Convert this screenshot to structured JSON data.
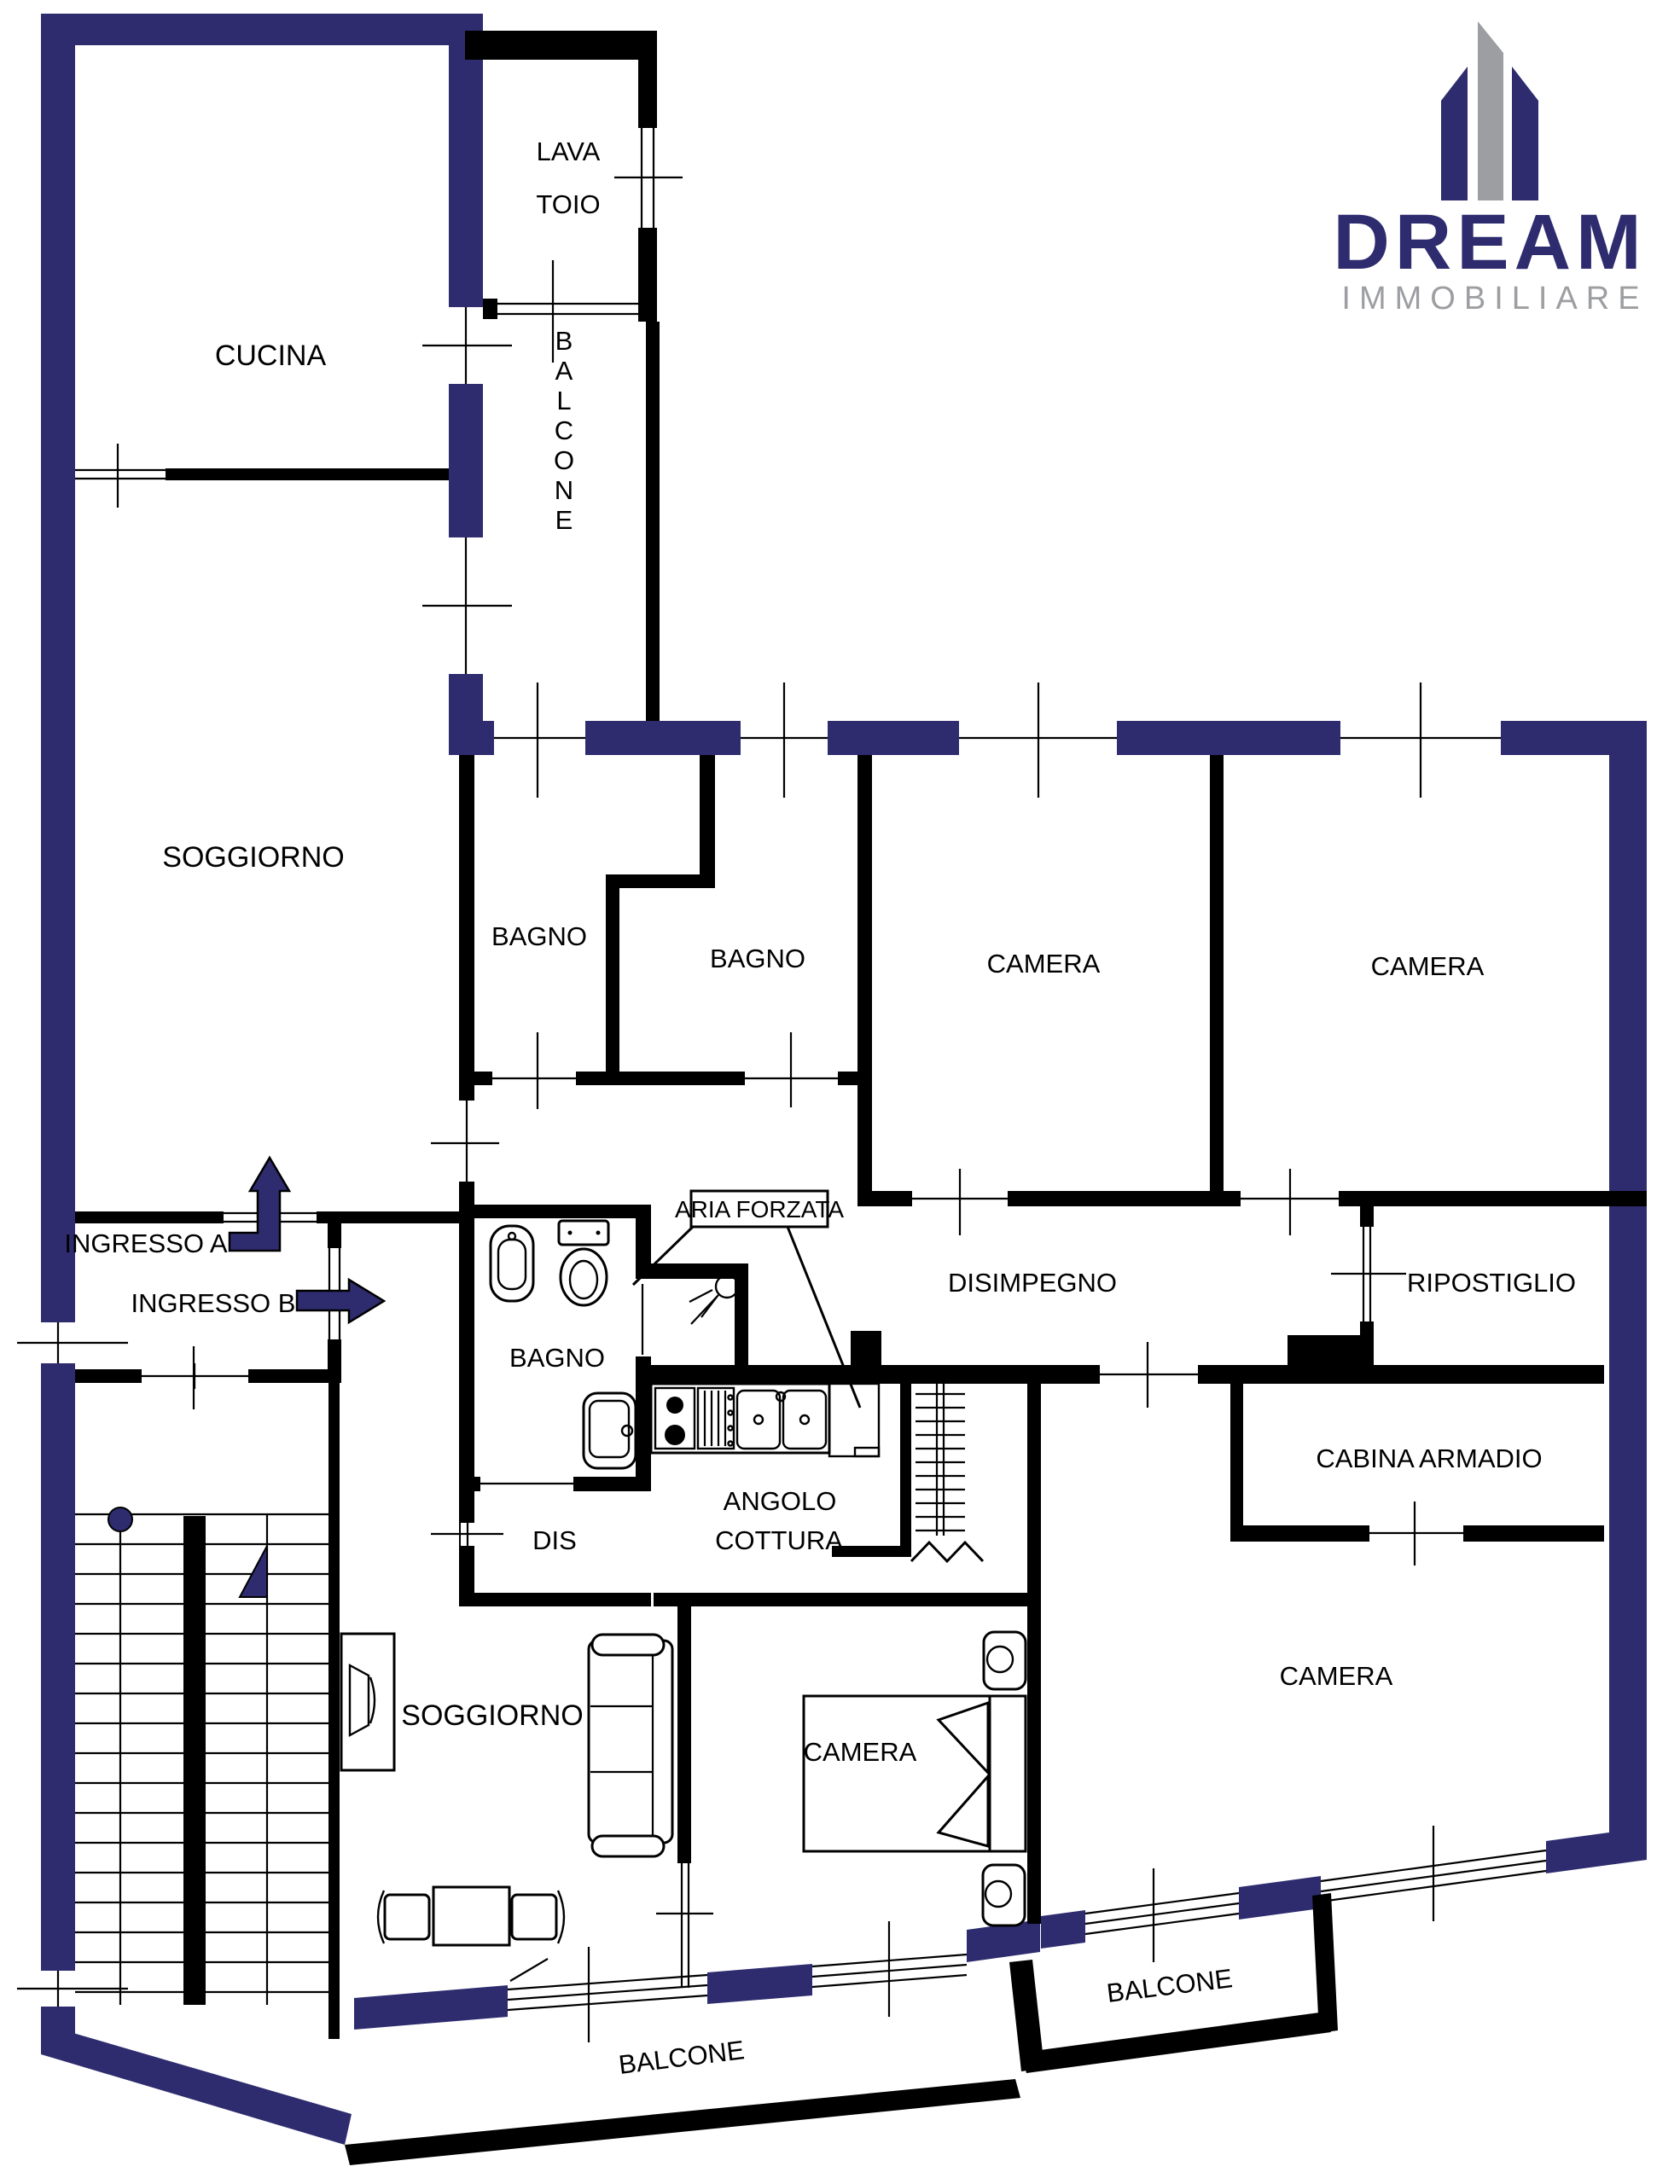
{
  "logo": {
    "brand": "DREAM",
    "subtitle": "IMMOBILIARE"
  },
  "colors": {
    "wall_navy": "#2e2c6e",
    "wall_black": "#000000",
    "logo_gray": "#9c9ea1",
    "background": "#ffffff"
  },
  "rooms": {
    "cucina": "CUCINA",
    "lavatoio_line1": "LAVA",
    "lavatoio_line2": "TOIO",
    "balcone_vertical": "BALCONE",
    "soggiorno_upper": "SOGGIORNO",
    "bagno_1": "BAGNO",
    "bagno_2": "BAGNO",
    "camera_1": "CAMERA",
    "camera_2": "CAMERA",
    "ingresso_a": "INGRESSO A",
    "ingresso_b": "INGRESSO B",
    "aria_forzata": "ARIA FORZATA",
    "bagno_lower": "BAGNO",
    "disimpegno": "DISIMPEGNO",
    "ripostiglio": "RIPOSTIGLIO",
    "dis": "DIS",
    "angolo_line1": "ANGOLO",
    "angolo_line2": "COTTURA",
    "cabina_armadio": "CABINA ARMADIO",
    "camera_big": "CAMERA",
    "soggiorno_lower": "SOGGIORNO",
    "camera_mid": "CAMERA",
    "balcone_big": "BALCONE",
    "balcone_small": "BALCONE"
  }
}
